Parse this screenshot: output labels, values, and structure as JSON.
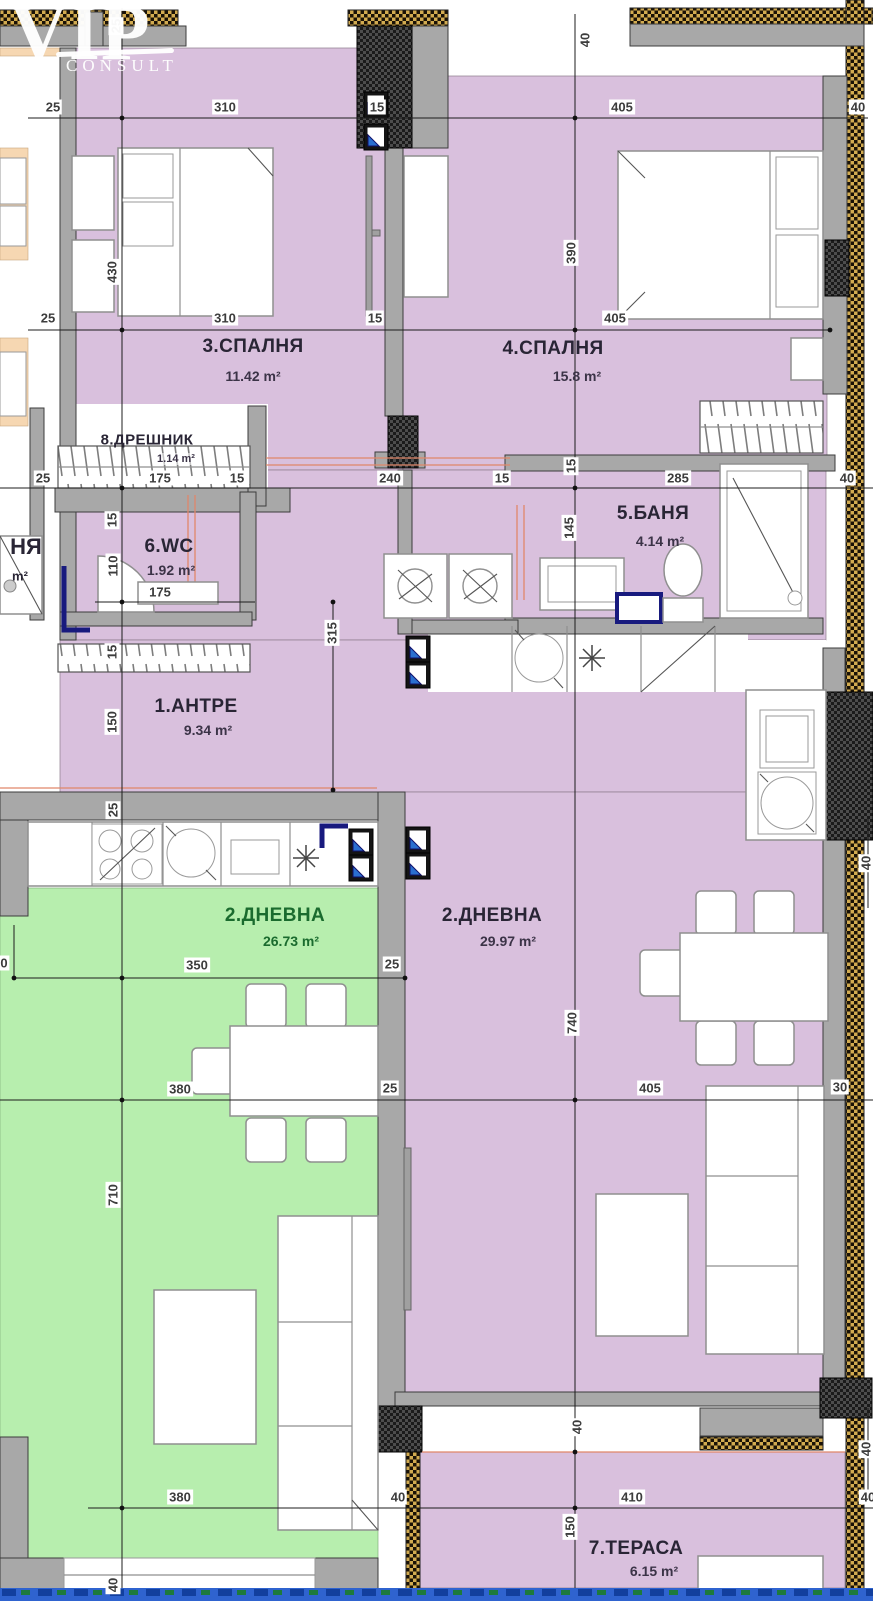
{
  "watermark": {
    "brand": "VIP",
    "sub": "CONSULT"
  },
  "palette": {
    "lavender": "#d9c0dd",
    "green": "#b7eeae",
    "green_text": "#1a6b2e",
    "peach": "#f6d7b2",
    "wall": "#a8a8a8",
    "hatch_tan": "#d2ab50",
    "shaft_dark": "#1b1b1b",
    "navy": "#181a7e",
    "band_blue": "#2f63cf",
    "label": "#292535",
    "dim_text": "#3c3c3c",
    "pipe": "#e0876a"
  },
  "room_labels": [
    {
      "name": "3.СПАЛНЯ",
      "area": "11.42 m²",
      "x": 253,
      "y": 347,
      "ax": 253,
      "ay": 376
    },
    {
      "name": "4.СПАЛНЯ",
      "area": "15.8 m²",
      "x": 553,
      "y": 349,
      "ax": 577,
      "ay": 376
    },
    {
      "name": "8.ДРЕШНИК",
      "area": "1.14 m²",
      "x": 147,
      "y": 440,
      "ax": 176,
      "ay": 459,
      "small": true
    },
    {
      "name": "6.WC",
      "area": "1.92 m²",
      "x": 169,
      "y": 547,
      "ax": 171,
      "ay": 570
    },
    {
      "name": "5.БАНЯ",
      "area": "4.14 m²",
      "x": 653,
      "y": 514,
      "ax": 660,
      "ay": 541
    },
    {
      "name": "1.АНТРЕ",
      "area": "9.34 m²",
      "x": 196,
      "y": 707,
      "ax": 208,
      "ay": 730
    },
    {
      "name": "2.ДНЕВНА",
      "area": "26.73 m²",
      "x": 275,
      "y": 916,
      "ax": 291,
      "ay": 941,
      "green": true
    },
    {
      "name": "2.ДНЕВНА",
      "area": "29.97 m²",
      "x": 492,
      "y": 916,
      "ax": 508,
      "ay": 941
    },
    {
      "name": "7.ТЕРАСА",
      "area": "6.15 m²",
      "x": 636,
      "y": 1549,
      "ax": 654,
      "ay": 1571
    }
  ],
  "partial_labels": [
    {
      "t": "НЯ",
      "x": 26,
      "y": 547,
      "big": true
    },
    {
      "t": "m²",
      "x": 20,
      "y": 576
    }
  ],
  "dimensions": [
    {
      "t": "25",
      "x": 53,
      "y": 107
    },
    {
      "t": "310",
      "x": 225,
      "y": 107
    },
    {
      "t": "15",
      "x": 377,
      "y": 107
    },
    {
      "t": "405",
      "x": 622,
      "y": 107
    },
    {
      "t": "40",
      "x": 858,
      "y": 107
    },
    {
      "t": "25",
      "x": 116,
      "y": 26,
      "r": true
    },
    {
      "t": "40",
      "x": 585,
      "y": 40,
      "r": true
    },
    {
      "t": "430",
      "x": 112,
      "y": 272,
      "r": true
    },
    {
      "t": "390",
      "x": 571,
      "y": 253,
      "r": true
    },
    {
      "t": "25",
      "x": 48,
      "y": 318
    },
    {
      "t": "310",
      "x": 225,
      "y": 318
    },
    {
      "t": "15",
      "x": 375,
      "y": 318
    },
    {
      "t": "405",
      "x": 615,
      "y": 318
    },
    {
      "t": "25",
      "x": 43,
      "y": 478
    },
    {
      "t": "175",
      "x": 160,
      "y": 478
    },
    {
      "t": "15",
      "x": 237,
      "y": 478
    },
    {
      "t": "240",
      "x": 390,
      "y": 478
    },
    {
      "t": "15",
      "x": 502,
      "y": 478
    },
    {
      "t": "285",
      "x": 678,
      "y": 478
    },
    {
      "t": "40",
      "x": 847,
      "y": 478
    },
    {
      "t": "15",
      "x": 571,
      "y": 466,
      "r": true
    },
    {
      "t": "145",
      "x": 569,
      "y": 528,
      "r": true
    },
    {
      "t": "15",
      "x": 112,
      "y": 520,
      "r": true
    },
    {
      "t": "110",
      "x": 113,
      "y": 566,
      "r": true
    },
    {
      "t": "175",
      "x": 160,
      "y": 592
    },
    {
      "t": "15",
      "x": 112,
      "y": 652,
      "r": true
    },
    {
      "t": "315",
      "x": 332,
      "y": 633,
      "r": true
    },
    {
      "t": "150",
      "x": 112,
      "y": 722,
      "r": true
    },
    {
      "t": "25",
      "x": 113,
      "y": 810,
      "r": true
    },
    {
      "t": "0",
      "x": 4,
      "y": 963
    },
    {
      "t": "350",
      "x": 197,
      "y": 965
    },
    {
      "t": "25",
      "x": 392,
      "y": 964
    },
    {
      "t": "380",
      "x": 180,
      "y": 1089
    },
    {
      "t": "25",
      "x": 390,
      "y": 1088
    },
    {
      "t": "405",
      "x": 650,
      "y": 1088
    },
    {
      "t": "30",
      "x": 840,
      "y": 1087
    },
    {
      "t": "710",
      "x": 113,
      "y": 1195,
      "r": true
    },
    {
      "t": "740",
      "x": 572,
      "y": 1023,
      "r": true
    },
    {
      "t": "40",
      "x": 866,
      "y": 863,
      "r": true
    },
    {
      "t": "40",
      "x": 577,
      "y": 1427,
      "r": true
    },
    {
      "t": "380",
      "x": 180,
      "y": 1497
    },
    {
      "t": "40",
      "x": 398,
      "y": 1497
    },
    {
      "t": "410",
      "x": 632,
      "y": 1497
    },
    {
      "t": "40",
      "x": 866,
      "y": 1449,
      "r": true
    },
    {
      "t": "40",
      "x": 868,
      "y": 1497
    },
    {
      "t": "150",
      "x": 570,
      "y": 1527,
      "r": true
    },
    {
      "t": "40",
      "x": 113,
      "y": 1585,
      "r": true
    }
  ]
}
